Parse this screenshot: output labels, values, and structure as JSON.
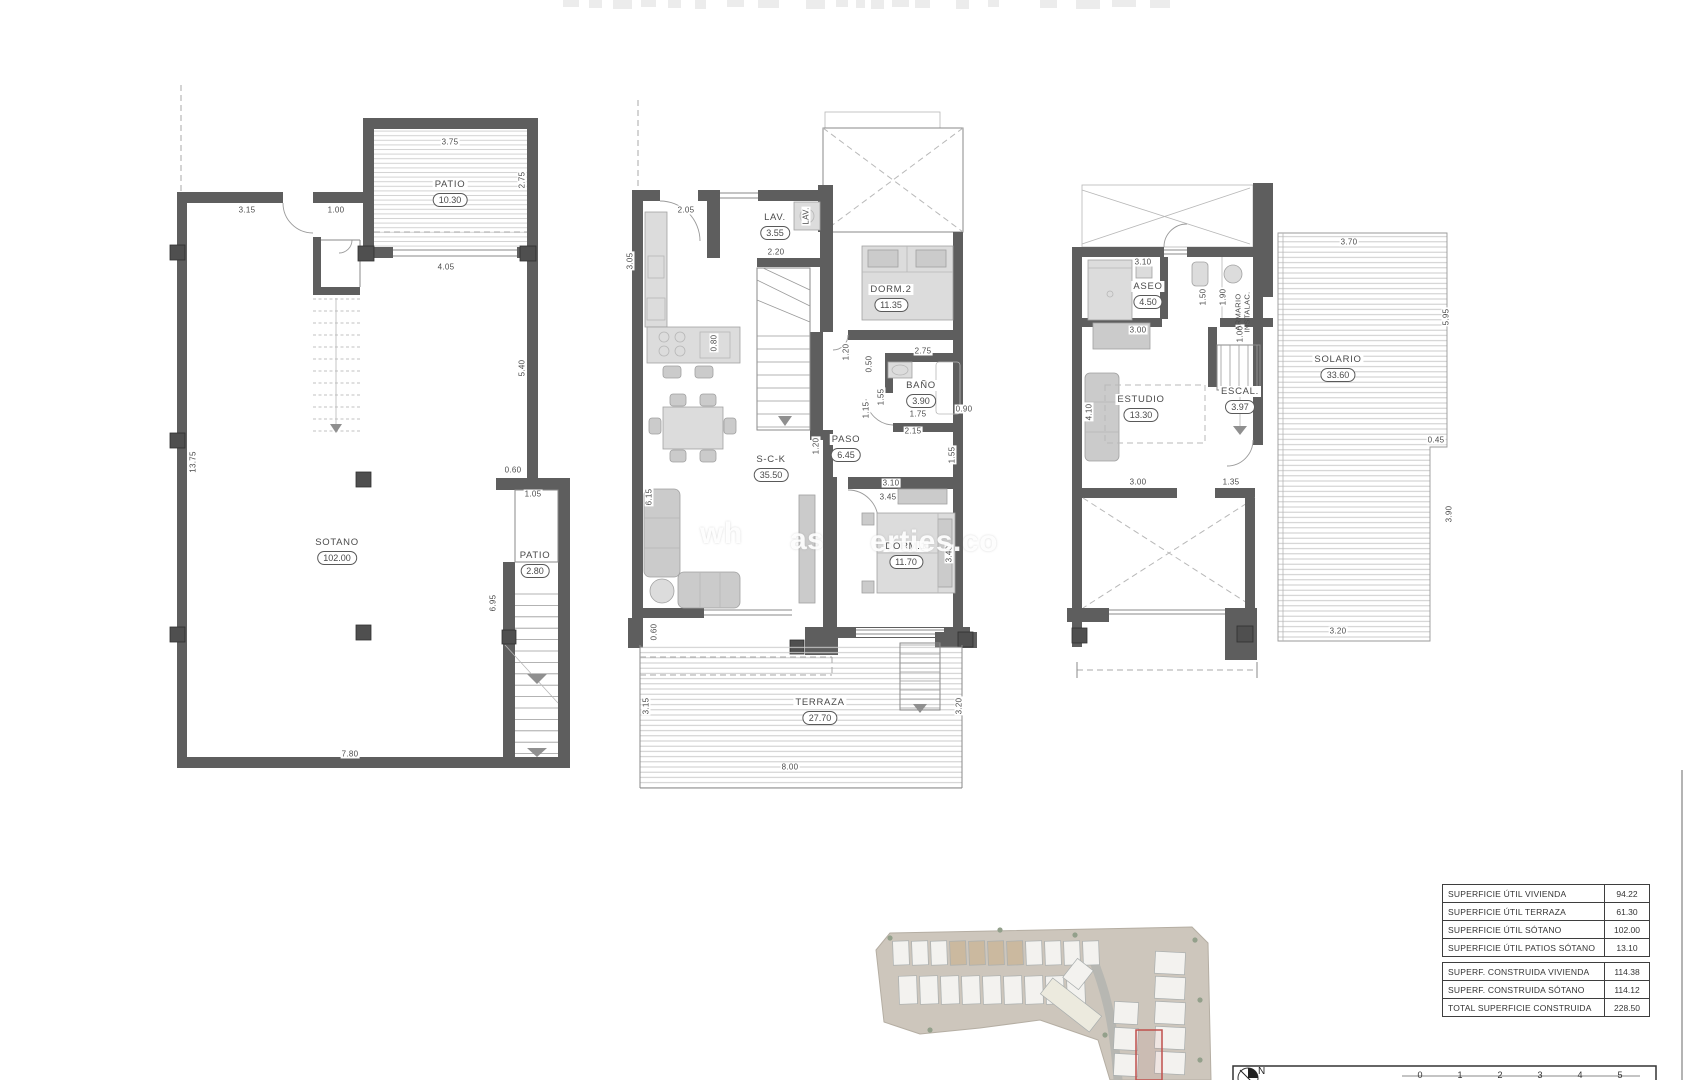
{
  "watermark": {
    "fragments": [
      {
        "t": "wh",
        "x": 700,
        "y": 517
      },
      {
        "t": "as",
        "x": 790,
        "y": 523
      },
      {
        "t": "erties.co",
        "x": 870,
        "y": 525
      }
    ]
  },
  "plans": [
    {
      "id": "planta-sotano",
      "rooms": [
        {
          "name": "PATIO",
          "area": "10.30",
          "x": 450,
          "y": 185
        },
        {
          "name": "SOTANO",
          "area": "102.00",
          "x": 337,
          "y": 543
        },
        {
          "name": "PATIO",
          "area": "2.80",
          "x": 535,
          "y": 556
        }
      ],
      "dims": [
        {
          "t": "3.75",
          "x": 450,
          "y": 142
        },
        {
          "t": "2.75",
          "x": 522,
          "y": 180,
          "rot": true
        },
        {
          "t": "3.15",
          "x": 247,
          "y": 210
        },
        {
          "t": "1.00",
          "x": 336,
          "y": 210
        },
        {
          "t": "4.05",
          "x": 446,
          "y": 267
        },
        {
          "t": "5.40",
          "x": 522,
          "y": 368,
          "rot": true
        },
        {
          "t": "13.75",
          "x": 193,
          "y": 462,
          "rot": true
        },
        {
          "t": "0.60",
          "x": 513,
          "y": 470
        },
        {
          "t": "1.05",
          "x": 533,
          "y": 494
        },
        {
          "t": "6.95",
          "x": 493,
          "y": 603,
          "rot": true
        },
        {
          "t": "7.80",
          "x": 350,
          "y": 754
        }
      ]
    },
    {
      "id": "planta-baja",
      "rooms": [
        {
          "name": "LAV.",
          "area": "3.55",
          "x": 775,
          "y": 218
        },
        {
          "name": "DORM.2",
          "area": "11.35",
          "x": 891,
          "y": 290
        },
        {
          "name": "BAÑO",
          "area": "3.90",
          "x": 921,
          "y": 386
        },
        {
          "name": "PASO",
          "area": "6.45",
          "x": 846,
          "y": 440
        },
        {
          "name": "S-C-K",
          "area": "35.50",
          "x": 771,
          "y": 460
        },
        {
          "name": "DORM.1",
          "area": "11.70",
          "x": 906,
          "y": 547
        },
        {
          "name": "TERRAZA",
          "area": "27.70",
          "x": 820,
          "y": 703
        }
      ],
      "dims": [
        {
          "t": "2.05",
          "x": 686,
          "y": 210
        },
        {
          "t": "2.20",
          "x": 776,
          "y": 252
        },
        {
          "t": "LAV.",
          "x": 806,
          "y": 216,
          "rot": true
        },
        {
          "t": "3.05",
          "x": 630,
          "y": 261,
          "rot": true
        },
        {
          "t": "0.80",
          "x": 714,
          "y": 343,
          "rot": true
        },
        {
          "t": "2.75",
          "x": 923,
          "y": 351
        },
        {
          "t": "1.20",
          "x": 846,
          "y": 352,
          "rot": true
        },
        {
          "t": "0.50",
          "x": 869,
          "y": 364,
          "rot": true
        },
        {
          "t": "1.15",
          "x": 866,
          "y": 410,
          "rot": true
        },
        {
          "t": "1.55",
          "x": 881,
          "y": 397,
          "rot": true
        },
        {
          "t": "1.75",
          "x": 918,
          "y": 414
        },
        {
          "t": "0.90",
          "x": 964,
          "y": 409
        },
        {
          "t": "2.15",
          "x": 913,
          "y": 431
        },
        {
          "t": "1.55",
          "x": 952,
          "y": 455,
          "rot": true
        },
        {
          "t": "1.20",
          "x": 816,
          "y": 446,
          "rot": true
        },
        {
          "t": "3.10",
          "x": 891,
          "y": 483
        },
        {
          "t": "3.45",
          "x": 888,
          "y": 497
        },
        {
          "t": "3.40",
          "x": 949,
          "y": 554,
          "rot": true
        },
        {
          "t": "6.15",
          "x": 649,
          "y": 497,
          "rot": true
        },
        {
          "t": "0.60",
          "x": 654,
          "y": 632,
          "rot": true
        },
        {
          "t": "3.15",
          "x": 646,
          "y": 706,
          "rot": true
        },
        {
          "t": "3.20",
          "x": 959,
          "y": 706,
          "rot": true
        },
        {
          "t": "8.00",
          "x": 790,
          "y": 767
        }
      ]
    },
    {
      "id": "planta-primera",
      "rooms": [
        {
          "name": "ASEO",
          "area": "4.50",
          "x": 1148,
          "y": 287
        },
        {
          "name": "ESTUDIO",
          "area": "13.30",
          "x": 1141,
          "y": 400
        },
        {
          "name": "ESCAL.",
          "area": "3.97",
          "x": 1240,
          "y": 392
        },
        {
          "name": "SOLARIO",
          "area": "33.60",
          "x": 1338,
          "y": 360
        }
      ],
      "texts": [
        {
          "lines": [
            "ARMARIO",
            "INSTALAC."
          ],
          "x": 1243,
          "y": 312
        }
      ],
      "dims": [
        {
          "t": "3.10",
          "x": 1143,
          "y": 262
        },
        {
          "t": "1.50",
          "x": 1203,
          "y": 297,
          "rot": true
        },
        {
          "t": "1.90",
          "x": 1223,
          "y": 297,
          "rot": true
        },
        {
          "t": "1.00",
          "x": 1240,
          "y": 334,
          "rot": true
        },
        {
          "t": "3.00",
          "x": 1138,
          "y": 330
        },
        {
          "t": "4.10",
          "x": 1089,
          "y": 412,
          "rot": true
        },
        {
          "t": "3.70",
          "x": 1349,
          "y": 242
        },
        {
          "t": "5.95",
          "x": 1446,
          "y": 317,
          "rot": true
        },
        {
          "t": "0.45",
          "x": 1436,
          "y": 440
        },
        {
          "t": "3.90",
          "x": 1449,
          "y": 514,
          "rot": true
        },
        {
          "t": "3.00",
          "x": 1138,
          "y": 482
        },
        {
          "t": "1.35",
          "x": 1231,
          "y": 482
        },
        {
          "t": "3.20",
          "x": 1338,
          "y": 631
        }
      ]
    }
  ],
  "area_tables": [
    {
      "rows": [
        {
          "label": "SUPERFICIE ÚTIL VIVIENDA",
          "value": "94.22"
        },
        {
          "label": "SUPERFICIE ÚTIL TERRAZA",
          "value": "61.30"
        },
        {
          "label": "SUPERFICIE ÚTIL SÓTANO",
          "value": "102.00"
        },
        {
          "label": "SUPERFICIE ÚTIL PATIOS SÓTANO",
          "value": "13.10"
        }
      ]
    },
    {
      "rows": [
        {
          "label": "SUPERF. CONSTRUIDA VIVIENDA",
          "value": "114.38"
        },
        {
          "label": "SUPERF. CONSTRUIDA SÓTANO",
          "value": "114.12"
        },
        {
          "label": "TOTAL SUPERFICIE CONSTRUIDA",
          "value": "228.50"
        }
      ]
    }
  ],
  "scale_bar": {
    "north": "N",
    "ticks": [
      "0",
      "1",
      "2",
      "3",
      "4",
      "5"
    ]
  },
  "colors": {
    "wall": "#5e5e5e",
    "dim_text": "#4c4c4c",
    "red_outline": "#c0504d",
    "site_bg": "#cdc6bc"
  }
}
